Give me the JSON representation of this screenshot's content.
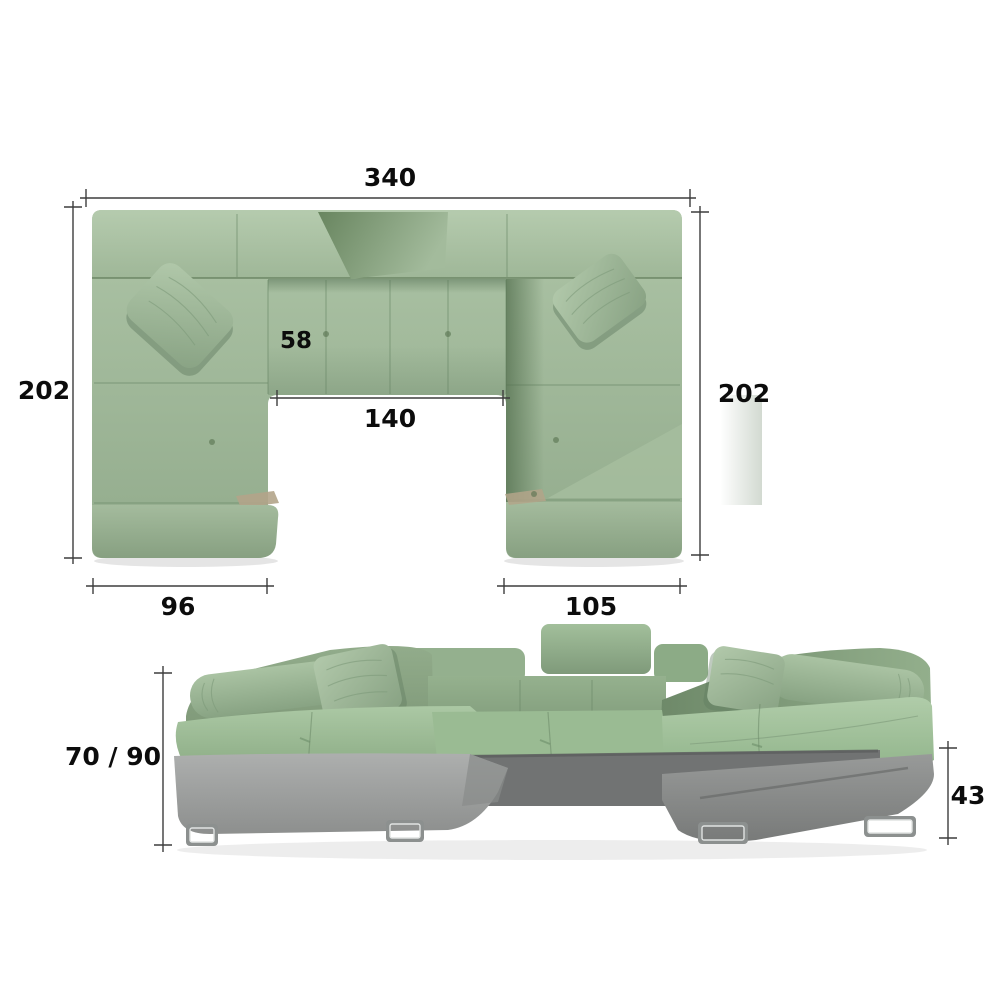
{
  "figure": {
    "type": "sofa-dimension-diagram",
    "top_view": {
      "dimensions": {
        "total_width": "340",
        "left_side_depth": "202",
        "right_side_depth": "202",
        "seat_module_width": "58",
        "inner_opening_width": "140",
        "left_section_width": "96",
        "right_section_width": "105"
      }
    },
    "front_view": {
      "dimensions": {
        "back_height_range": "70 / 90",
        "seat_height": "43"
      }
    },
    "colors": {
      "background": "#ffffff",
      "fabric_green_light": "#aec6a8",
      "fabric_green": "#9ab693",
      "fabric_green_dark": "#6d8a6d",
      "base_gray_light": "#a2a4a3",
      "base_gray_mid": "#8b8d8c",
      "base_gray_dark": "#737575",
      "leg_chrome": "#8c908f",
      "dimension_line": "#3d3d3d",
      "dimension_text": "#0c0c0c"
    }
  }
}
